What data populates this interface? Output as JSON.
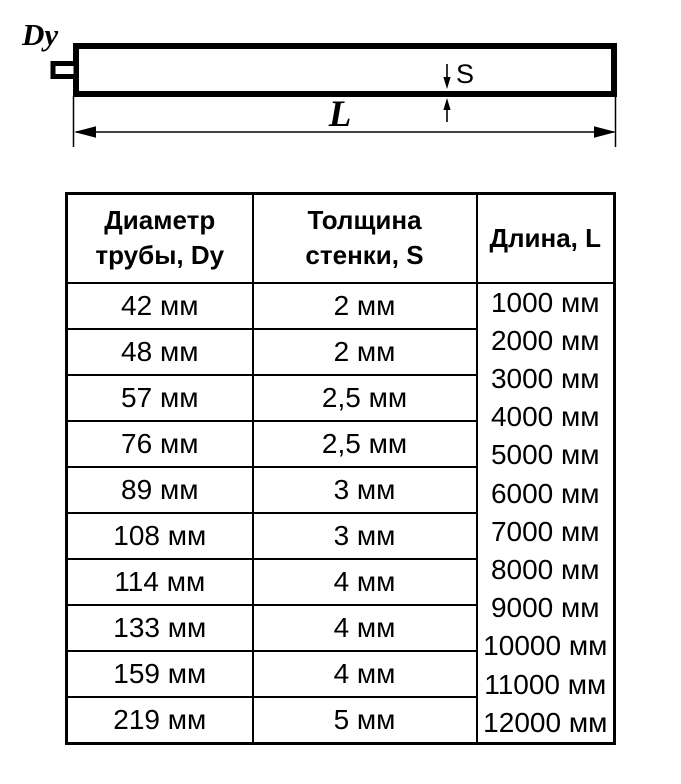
{
  "diagram": {
    "diameter_label": "Dy",
    "thickness_label": "S",
    "length_label": "L"
  },
  "table": {
    "headers": {
      "diameter": [
        "Диаметр",
        "трубы, Dy"
      ],
      "thickness": [
        "Толщина",
        "стенки, S"
      ],
      "length": "Длина, L"
    },
    "rows": [
      {
        "diameter": "42 мм",
        "thickness": "2 мм"
      },
      {
        "diameter": "48 мм",
        "thickness": "2 мм"
      },
      {
        "diameter": "57 мм",
        "thickness": "2,5 мм"
      },
      {
        "diameter": "76 мм",
        "thickness": "2,5 мм"
      },
      {
        "diameter": "89 мм",
        "thickness": "3 мм"
      },
      {
        "diameter": "108 мм",
        "thickness": "3 мм"
      },
      {
        "diameter": "114 мм",
        "thickness": "4 мм"
      },
      {
        "diameter": "133 мм",
        "thickness": "4 мм"
      },
      {
        "diameter": "159 мм",
        "thickness": "4 мм"
      },
      {
        "diameter": "219 мм",
        "thickness": "5 мм"
      }
    ],
    "lengths": [
      "1000 мм",
      "2000 мм",
      "3000 мм",
      "4000 мм",
      "5000 мм",
      "6000 мм",
      "7000 мм",
      "8000 мм",
      "9000 мм",
      "10000 мм",
      "11000 мм",
      "12000 мм"
    ]
  },
  "colors": {
    "line": "#000000",
    "background": "#ffffff"
  }
}
